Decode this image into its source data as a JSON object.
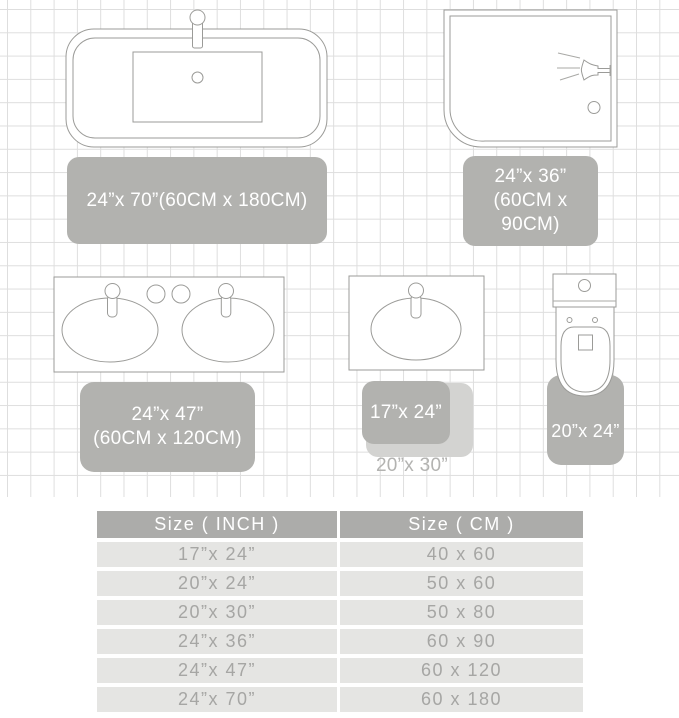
{
  "diagram": {
    "bathtub_rug_label": "24”x 70”(60CM x 180CM)",
    "shower_rug_label_line1": "24”x 36”",
    "shower_rug_label_line2": "(60CM x 90CM)",
    "vanity_rug_label_line1": "24”x 47”",
    "vanity_rug_label_line2": "(60CM x 120CM)",
    "sink_rug_small_label": "17”x 24”",
    "sink_rug_large_label": "20”x 30”",
    "toilet_rug_label": "20”x 24”"
  },
  "size_table": {
    "header_inch": "Size ( INCH )",
    "header_cm": "Size ( CM )",
    "rows": [
      {
        "inch": "17”x 24”",
        "cm": "40 x 60"
      },
      {
        "inch": "20”x 24”",
        "cm": "50 x 60"
      },
      {
        "inch": "20”x 30”",
        "cm": "50 x 80"
      },
      {
        "inch": "24”x 36”",
        "cm": "60 x 90"
      },
      {
        "inch": "24”x 47”",
        "cm": "60 x 120"
      },
      {
        "inch": "24”x 70”",
        "cm": "60 x 180"
      }
    ]
  },
  "colors": {
    "rug": "#b2b2af",
    "rug_light": "#d3d3d1",
    "outline": "#9b9b98",
    "grid_line": "#dedede",
    "table_header_bg": "#acacaa",
    "table_row_bg": "#e5e5e3",
    "table_row_text": "#a6a6a4",
    "rug_label_text": "#ffffff"
  }
}
